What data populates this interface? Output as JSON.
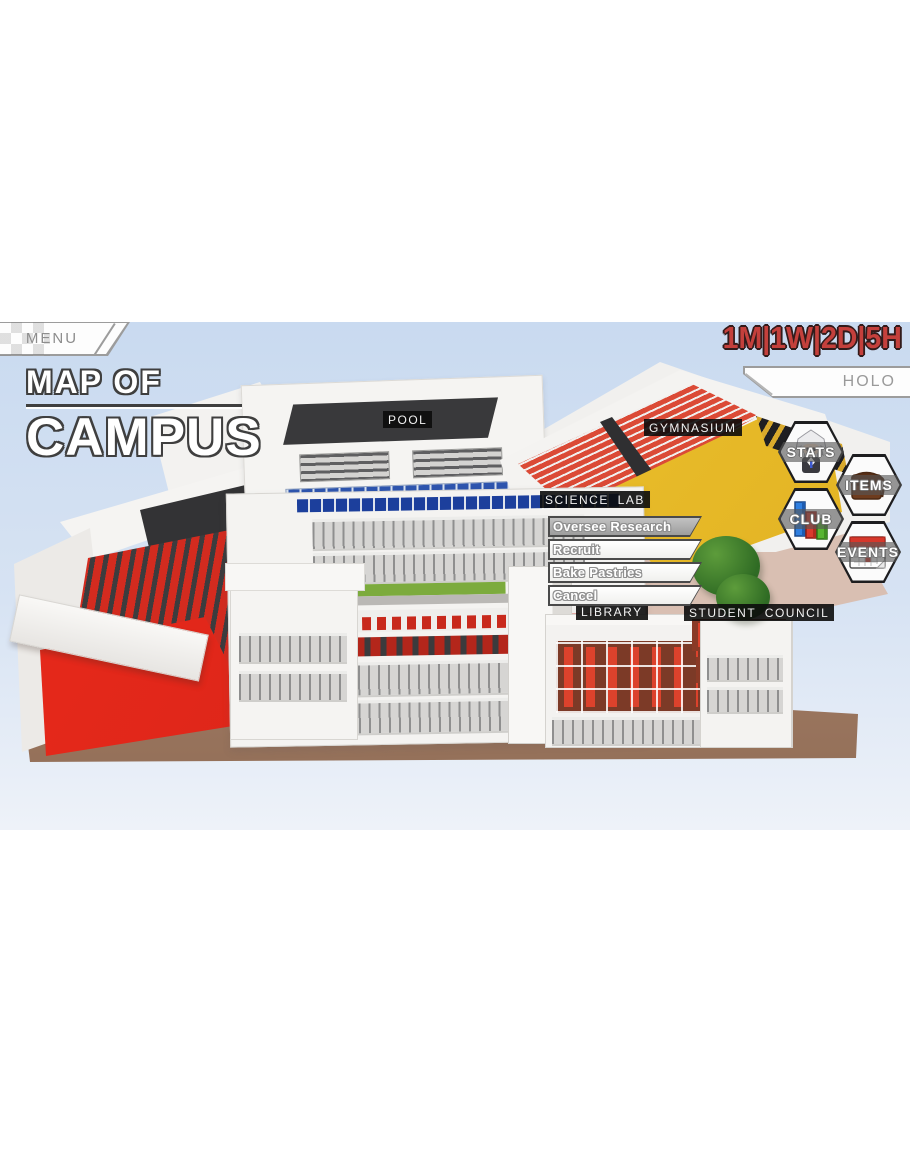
{
  "header": {
    "menu_button": "MENU",
    "time_display": "1M|1W|2D|5H",
    "holo_tab": "HOLO",
    "title_line1": "MAP OF",
    "title_line2": "CAMPUS"
  },
  "map": {
    "building_labels": [
      {
        "id": "pool",
        "label": "POOL"
      },
      {
        "id": "gymnasium",
        "label": "GYMNASIUM"
      },
      {
        "id": "science-lab",
        "label": "SCIENCE LAB"
      },
      {
        "id": "library",
        "label": "LIBRARY"
      },
      {
        "id": "student-council",
        "label": "STUDENT COUNCIL"
      }
    ]
  },
  "context_menu": {
    "items": [
      {
        "label": "Oversee Research",
        "selected": true
      },
      {
        "label": "Recruit",
        "selected": false
      },
      {
        "label": "Bake Pastries",
        "selected": false
      },
      {
        "label": "Cancel",
        "selected": false
      }
    ]
  },
  "side_buttons": [
    {
      "label": "STATS",
      "icon": "avatar-icon"
    },
    {
      "label": "ITEMS",
      "icon": "bag-icon"
    },
    {
      "label": "CLUB",
      "icon": "bar-chart-icon"
    },
    {
      "label": "EVENTS",
      "icon": "calendar-icon"
    }
  ],
  "colors": {
    "sky_top": "#c9daf0",
    "sky_bottom": "#eef2f9",
    "time_red": "#c4403c",
    "label_bg": "#0c0c0c",
    "selected_item_gray": "#ababab",
    "gym_bleacher_red": "#db4a36",
    "court_yellow": "#eec22c",
    "auditorium_red": "#d92b20",
    "ground_brown": "#a07a63",
    "pool_blue": "#2e55ae",
    "grass_green": "#7cab3d"
  }
}
